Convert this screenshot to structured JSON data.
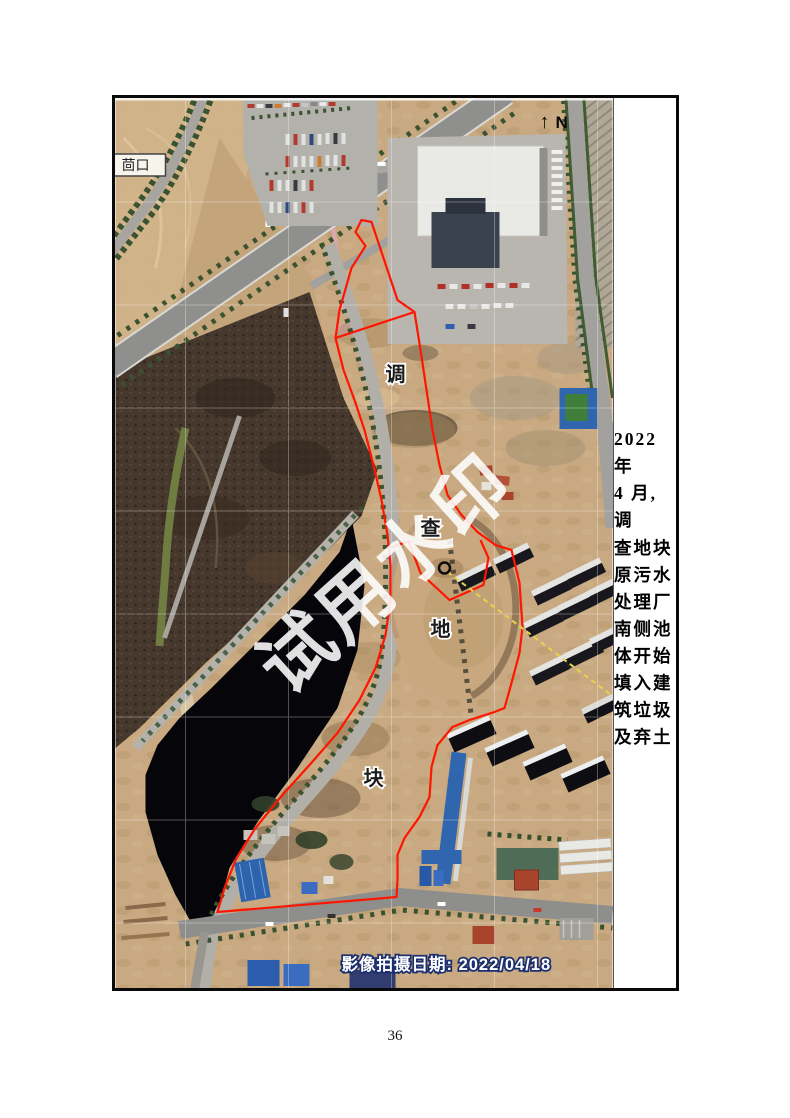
{
  "page": {
    "number": "36"
  },
  "figure": {
    "side_note": "2022 年\n4 月,调\n查地块\n原污水\n处理厂\n南侧池\n体开始\n填入建\n筑垃圾\n及弃土"
  },
  "map": {
    "watermark": "试用水印",
    "north": "N",
    "north_arrow": "↑",
    "place_label": "茴口",
    "plot_labels": [
      "调",
      "查",
      "地",
      "块"
    ],
    "capture_date": "影像拍摄日期: 2022/04/18",
    "colors": {
      "boundary": "#ff1500",
      "survey_line": "#e6d44a",
      "water": "#06060a",
      "earth": "#c8a981",
      "road": "#9a9995"
    }
  }
}
